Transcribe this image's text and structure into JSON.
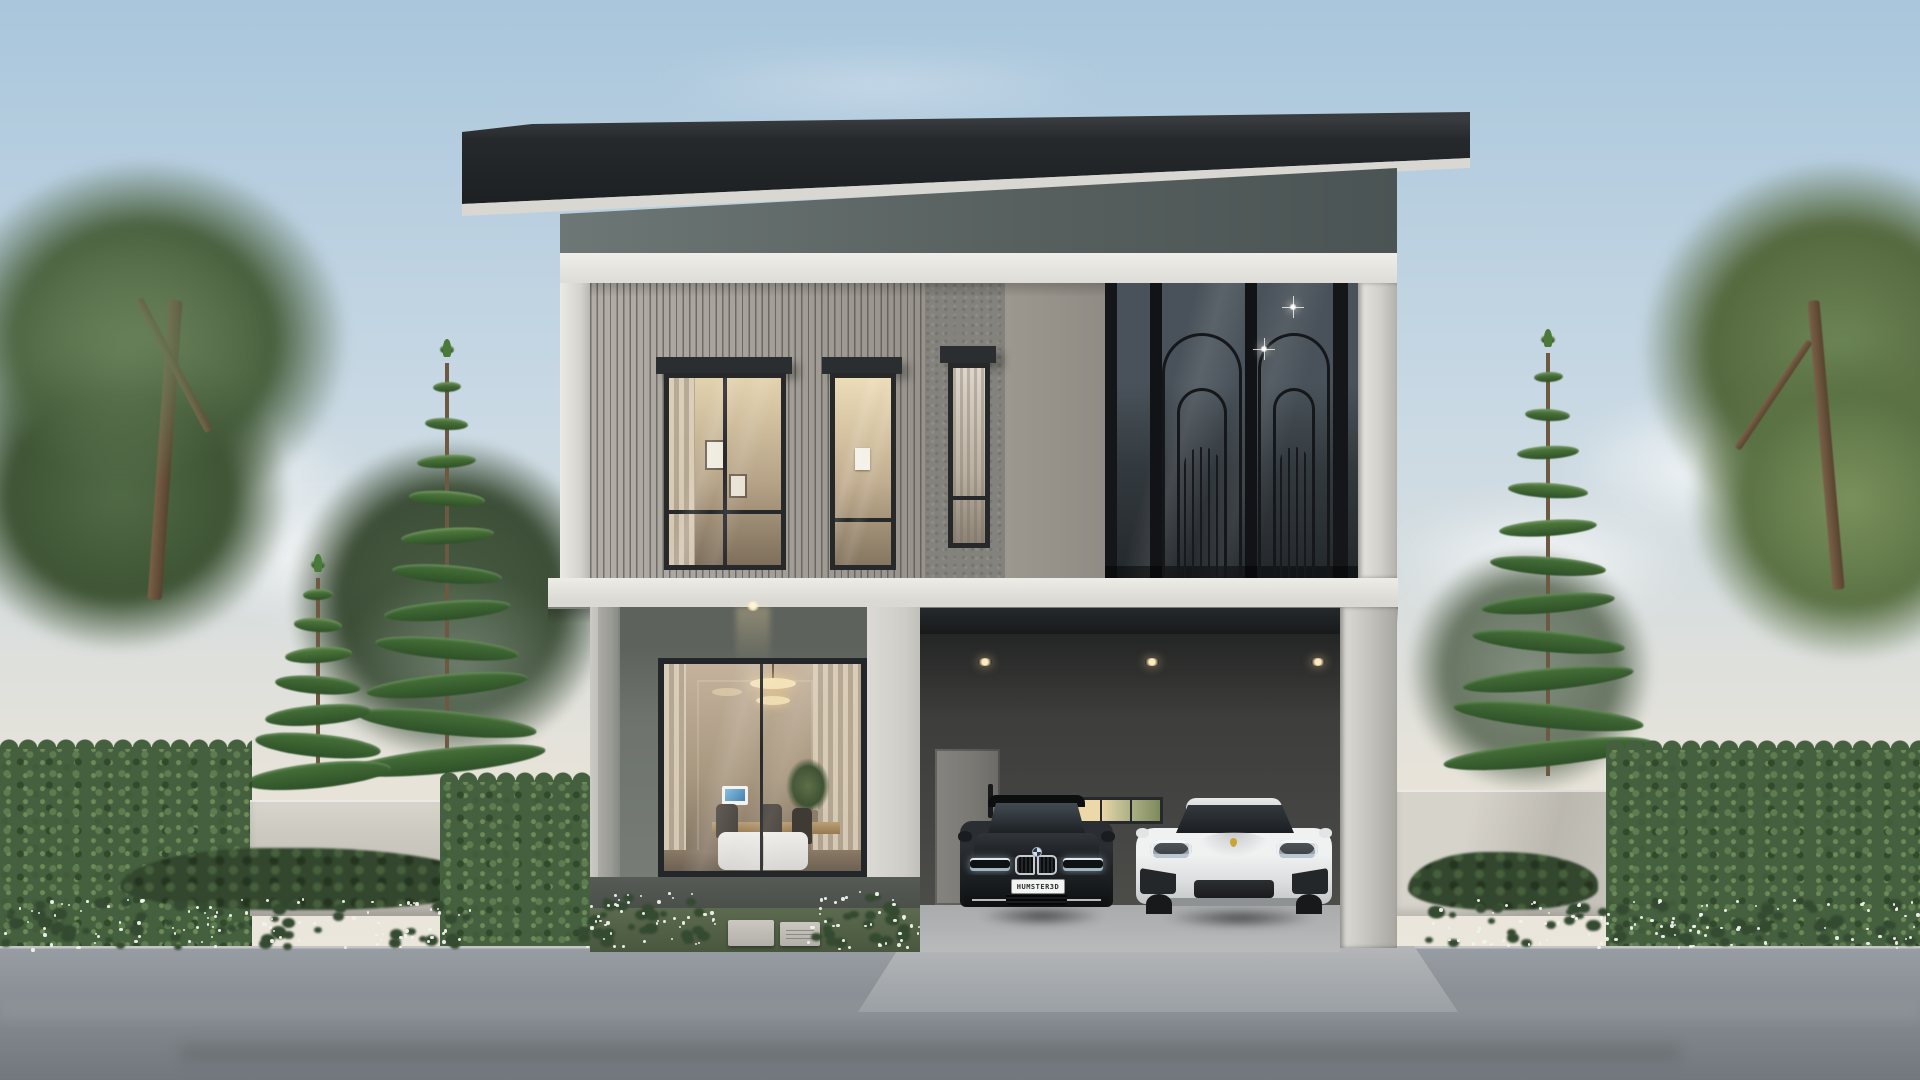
{
  "meta": {
    "kind": "architectural exterior rendering",
    "subject": "modern two-storey house with double carport, evening-lit interiors, garden hedges and asphalt street",
    "time_of_day": "daytime, soft sky"
  },
  "vehicles": {
    "sedan": {
      "style": "black luxury sedan",
      "license_plate": "HUMSTER3D"
    },
    "sports_car": {
      "style": "white electric sports car"
    }
  },
  "palette": {
    "sky-top": "#a9c6dc",
    "sky-mid": "#c9d9e4",
    "sky-low": "#e7e3d9",
    "sky-horizon": "#efe8dd",
    "roof": "#232628",
    "soffit": "#d9d7d1",
    "band-white": "#ebe9e3",
    "slat": "#a6a29b",
    "stucco": "#969289",
    "ground-wall": "#6e736d",
    "bright-wall": "#d6d4ce",
    "carport-wall": "#454543",
    "carport-door": "#7a7873",
    "hedge": "#45603f",
    "wall-lit": "#ccc9c1",
    "road-top": "#979da2",
    "road-bottom": "#71777c",
    "interior-warm": "#e8d8b4",
    "chandelier": "#f3e2b8"
  },
  "decor": {
    "pines": [
      {
        "name": "pine-left-tall",
        "cx": 447,
        "top": 345,
        "bottom": 778,
        "halfW": 92,
        "tiers": 12
      },
      {
        "name": "pine-left-short",
        "cx": 318,
        "top": 560,
        "bottom": 778,
        "halfW": 66,
        "tiers": 8
      },
      {
        "name": "pine-right",
        "cx": 1548,
        "top": 335,
        "bottom": 772,
        "halfW": 98,
        "tiers": 12
      },
      {
        "name": "pine-right-edge",
        "cx": 1904,
        "top": 880,
        "bottom": 1000,
        "halfW": 42,
        "tiers": 5
      }
    ],
    "flower_beds": [
      {
        "x": 0,
        "y": 898,
        "w": 475,
        "h": 54,
        "count": 95,
        "seed": 1
      },
      {
        "x": 575,
        "y": 891,
        "w": 142,
        "h": 60,
        "count": 42,
        "seed": 2
      },
      {
        "x": 806,
        "y": 891,
        "w": 120,
        "h": 60,
        "count": 36,
        "seed": 3
      },
      {
        "x": 1424,
        "y": 898,
        "w": 496,
        "h": 52,
        "count": 100,
        "seed": 4
      }
    ],
    "carport_lights": [
      {
        "x": 985
      },
      {
        "x": 1152
      },
      {
        "x": 1318
      }
    ],
    "porch_light": {
      "x": 752,
      "y": 603
    },
    "balcony_arches": [
      {
        "x": 1162,
        "w": 80
      },
      {
        "x": 1258,
        "w": 72
      }
    ],
    "balcony_glints": [
      {
        "x": 1293,
        "y": 307
      },
      {
        "x": 1264,
        "y": 349
      }
    ]
  }
}
